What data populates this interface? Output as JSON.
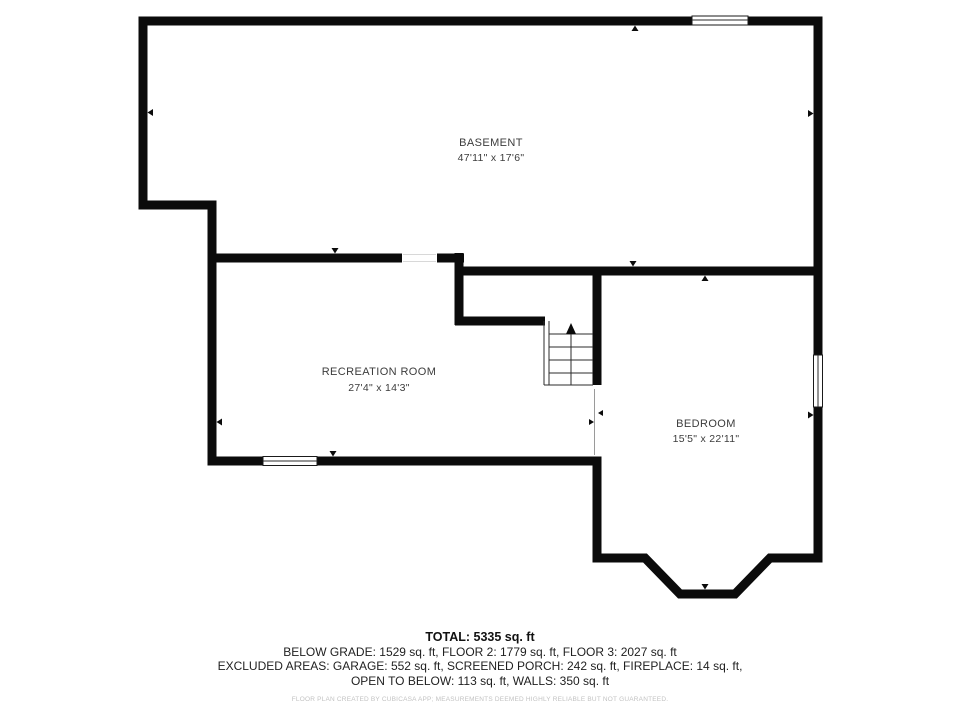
{
  "floor_plan": {
    "rooms": [
      {
        "name": "BASEMENT",
        "dimensions": "47'11\" x 17'6\""
      },
      {
        "name": "RECREATION ROOM",
        "dimensions": "27'4\" x 14'3\""
      },
      {
        "name": "BEDROOM",
        "dimensions": "15'5\" x 22'11\""
      }
    ],
    "stairs": {
      "direction": "up"
    }
  },
  "summary": {
    "total": "TOTAL: 5335 sq. ft",
    "floors_line": "BELOW GRADE: 1529 sq. ft, FLOOR 2: 1779 sq. ft, FLOOR 3: 2027 sq. ft",
    "excluded_line1": "EXCLUDED AREAS: GARAGE: 552 sq. ft, SCREENED PORCH: 242 sq. ft, FIREPLACE: 14 sq. ft,",
    "excluded_line2": "OPEN TO BELOW: 113 sq. ft, WALLS: 350 sq. ft"
  },
  "footer": {
    "disclaimer": "FLOOR PLAN CREATED BY CUBICASA APP; MEASUREMENTS DEEMED HIGHLY RELIABLE BUT NOT GUARANTEED."
  },
  "colors": {
    "wall": "#0b0b0b",
    "label_text": "#3c3c3c",
    "summary_text": "#1f1f1f",
    "disclaimer_text": "#c2c2c2",
    "background": "#ffffff"
  }
}
